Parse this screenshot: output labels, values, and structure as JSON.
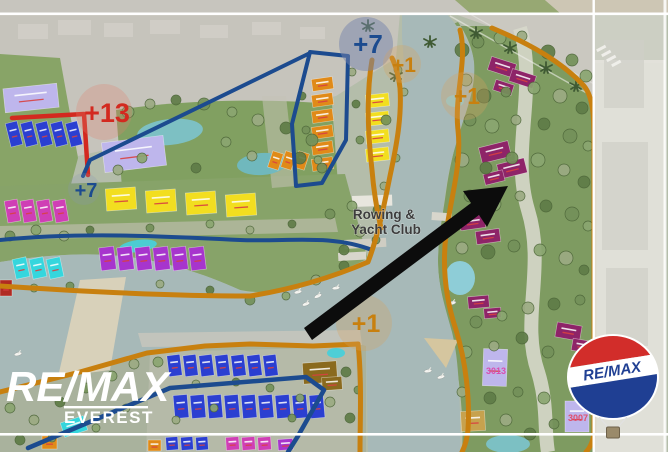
{
  "map": {
    "zone_labels": {
      "plus13": "+13",
      "plus7_large": "+7",
      "plus7_small": "+7",
      "plus1_top": "+1",
      "plus1_right": "+1",
      "plus1_bottom": "+1"
    },
    "poi": {
      "line1": "Rowing &",
      "line2": "Yacht Club"
    },
    "buildings": {
      "b3013": "3013",
      "b3007": "3007"
    }
  },
  "watermark": {
    "brand": "RE/MAX",
    "office": "EVEREST"
  },
  "balloon": {
    "brand": "RE/MAX"
  },
  "palette": {
    "zone_red": "#d3291f",
    "zone_navy": "#1c4b8f",
    "zone_orange": "#c8800f",
    "water": "#a7b9b8",
    "balloon_red": "#d22d2a",
    "balloon_blue": "#1f3f93",
    "watermark_white": "#ffffff"
  }
}
